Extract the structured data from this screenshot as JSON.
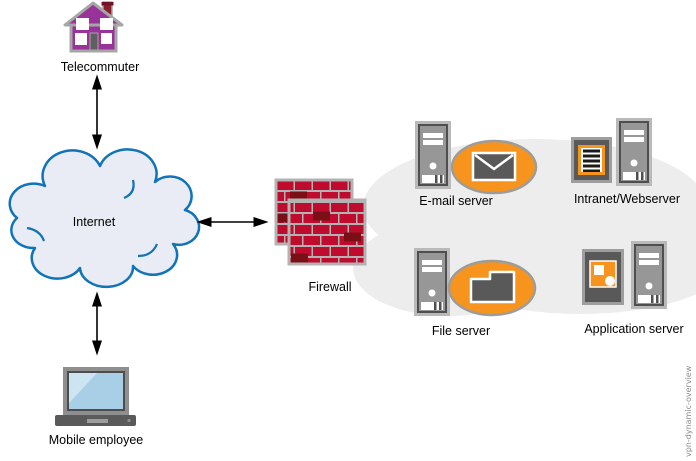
{
  "diagram": {
    "watermark": "vpn-dynamic-overview",
    "nodes": {
      "telecommuter": {
        "label": "Telecommuter",
        "icon": "house-icon"
      },
      "internet": {
        "label": "Internet",
        "icon": "cloud-icon"
      },
      "mobile_employee": {
        "label": "Mobile employee",
        "icon": "laptop-icon"
      },
      "firewall": {
        "label": "Firewall",
        "icon": "brick-wall-icon"
      },
      "email_server": {
        "label": "E-mail server",
        "icon": "server-tower-icon",
        "badge": "envelope-icon"
      },
      "intranet_webserver": {
        "label": "Intranet/Webserver",
        "icon": "server-tower-icon",
        "badge": "document-icon"
      },
      "file_server": {
        "label": "File server",
        "icon": "server-tower-icon",
        "badge": "folder-icon"
      },
      "application_server": {
        "label": "Application server",
        "icon": "server-tower-icon",
        "badge": "application-icon"
      }
    },
    "edges": [
      {
        "from": "telecommuter",
        "to": "internet",
        "style": "double-arrow"
      },
      {
        "from": "internet",
        "to": "firewall",
        "style": "double-arrow"
      },
      {
        "from": "mobile_employee",
        "to": "internet",
        "style": "double-arrow"
      }
    ],
    "zone": {
      "name": "internal-network",
      "members": [
        "email_server",
        "intranet_webserver",
        "file_server",
        "application_server"
      ]
    }
  },
  "colors": {
    "accent_orange": "#F7941E",
    "brick_red": "#BF0B2E",
    "brick_dark": "#7A1016",
    "cloud_stroke": "#1173B8",
    "cloud_fill": "#E9ECF5",
    "zone_fill": "#EDEDED",
    "house_purple": "#993399",
    "screen_blue": "#A9CFE7",
    "icon_gray": "#595959"
  }
}
